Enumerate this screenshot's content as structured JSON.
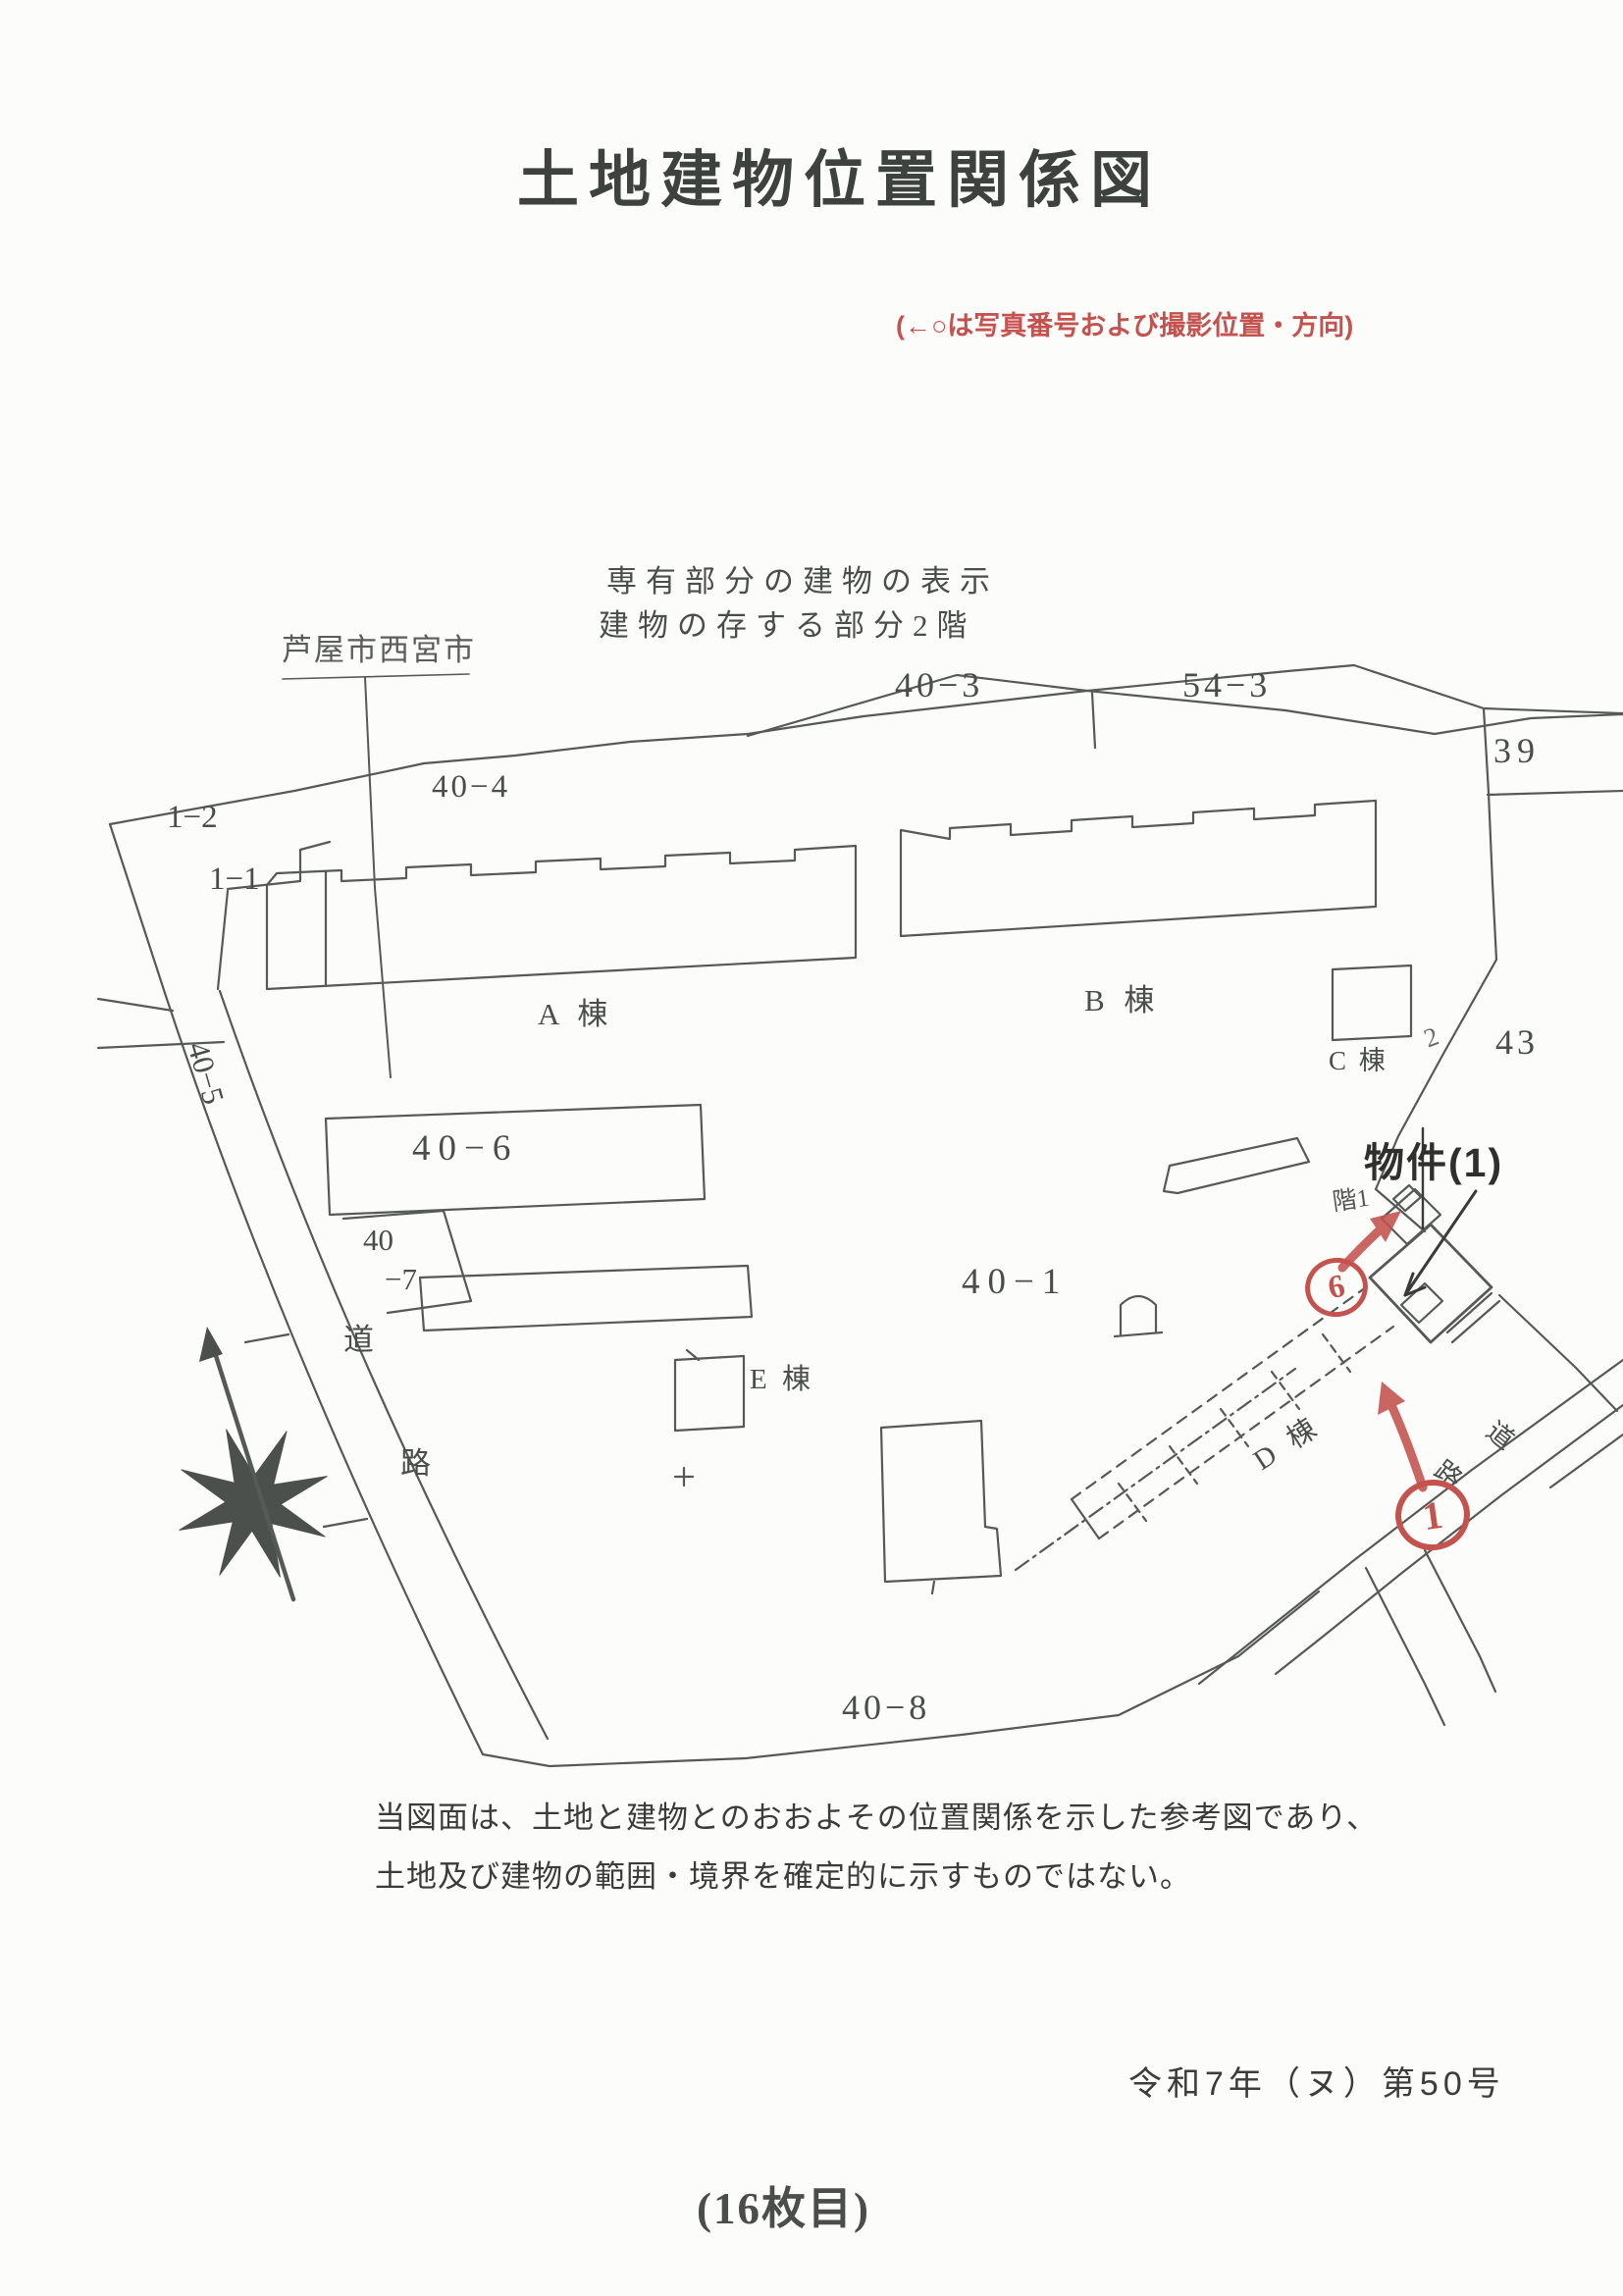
{
  "document": {
    "title": "土地建物位置関係図",
    "photo_note": "(←○は写真番号および撮影位置・方向)",
    "exclusive_note": {
      "line1": "専有部分の建物の表示",
      "line2": "建物の存する部分2階"
    },
    "city_boundary_label": "芦屋市西宮市",
    "disclaimer": {
      "line1": "当図面は、土地と建物とのおおよその位置関係を示した参考図であり、",
      "line2": "土地及び建物の範囲・境界を確定的に示すものではない。"
    },
    "case_number": "令和7年（ヌ）第50号",
    "sheet_number": "(16枚目)"
  },
  "map": {
    "lots": {
      "n40_3": "40−3",
      "n54_3": "54−3",
      "n39": "39",
      "n40_4": "40−4",
      "n1_2": "1−2",
      "n1_1": "1−1",
      "n40_5": "40−5",
      "n40_6": "40−6",
      "n40_7_top": "40",
      "n40_7_bottom": "−7",
      "n40_1": "40−1",
      "n43": "43",
      "n40_8": "40−8",
      "n2": "2"
    },
    "buildings": {
      "a": "A 棟",
      "b": "B 棟",
      "c": "C 棟",
      "d": "D 棟",
      "e": "E 棟"
    },
    "roads": {
      "left_top": "道",
      "left_bottom": "路",
      "right_top": "道",
      "right_bottom": "路"
    },
    "annotations": {
      "property": "物件(1)",
      "floor_note": "階1",
      "photo_marker_6": "6",
      "photo_marker_1": "1"
    }
  },
  "colors": {
    "ink": "#565a57",
    "text": "#3c3e3c",
    "red": "#c4524e"
  }
}
